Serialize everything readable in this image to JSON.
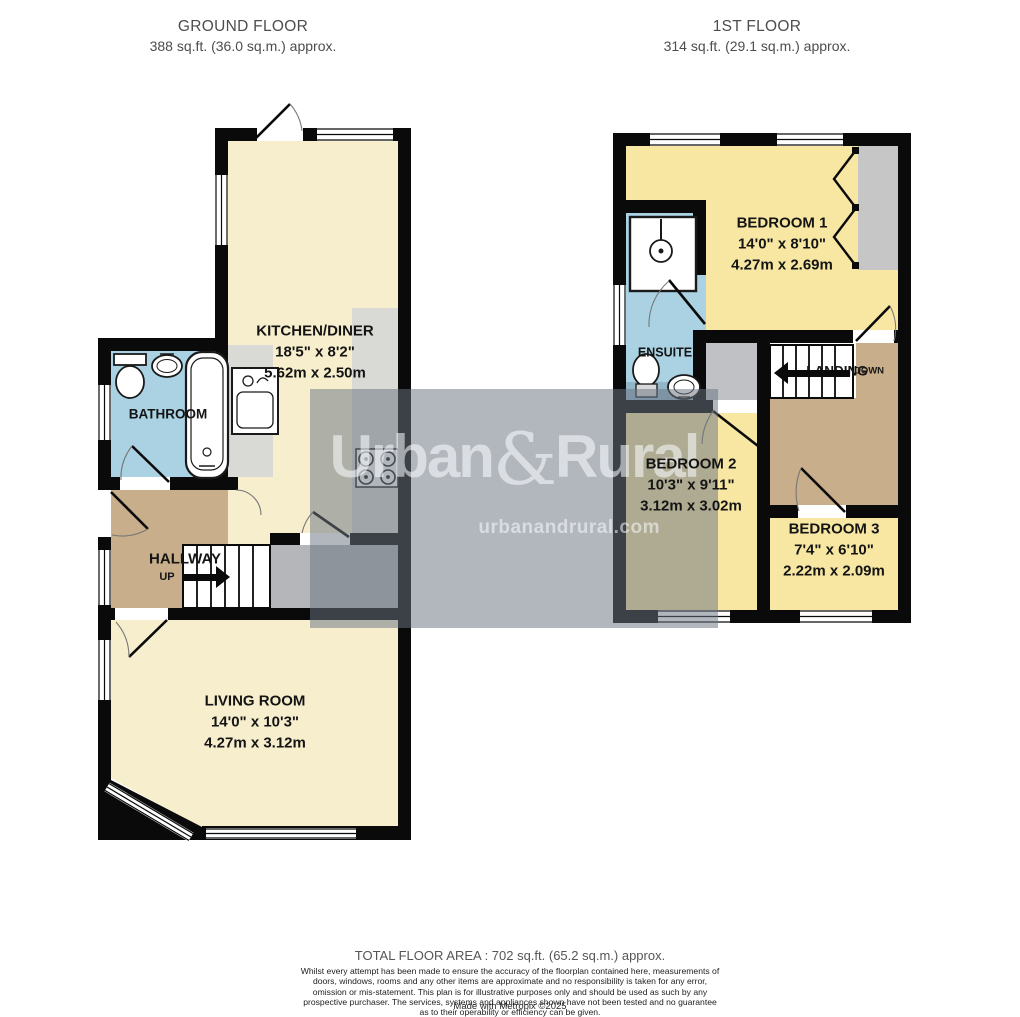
{
  "headers": {
    "ground_floor": {
      "title": "GROUND FLOOR",
      "area": "388 sq.ft. (36.0 sq.m.) approx."
    },
    "first_floor": {
      "title": "1ST FLOOR",
      "area": "314 sq.ft. (29.1 sq.m.) approx."
    }
  },
  "rooms": {
    "kitchen_diner": {
      "name": "KITCHEN/DINER",
      "size_imperial": "18'5\"  x 8'2\"",
      "size_metric": "5.62m  x 2.50m"
    },
    "bathroom": {
      "name": "BATHROOM"
    },
    "hallway": {
      "name": "HALLWAY",
      "direction": "UP"
    },
    "living_room": {
      "name": "LIVING ROOM",
      "size_imperial": "14'0\"  x 10'3\"",
      "size_metric": "4.27m  x 3.12m"
    },
    "bedroom_1": {
      "name": "BEDROOM 1",
      "size_imperial": "14'0\"  x 8'10\"",
      "size_metric": "4.27m  x 2.69m"
    },
    "ensuite": {
      "name": "ENSUITE"
    },
    "landing": {
      "name": "LANDING",
      "direction": "DOWN"
    },
    "bedroom_2": {
      "name": "BEDROOM 2",
      "size_imperial": "10'3\"  x 9'11\"",
      "size_metric": "3.12m  x 3.02m"
    },
    "bedroom_3": {
      "name": "BEDROOM 3",
      "size_imperial": "7'4\"  x 6'10\"",
      "size_metric": "2.22m  x 2.09m"
    }
  },
  "watermark": {
    "brand_first": "Urban",
    "brand_amp": "&",
    "brand_second": "Rural",
    "website": "urbanandrural.com"
  },
  "footer": {
    "total_area": "TOTAL FLOOR AREA : 702 sq.ft. (65.2 sq.m.) approx.",
    "disclaimer": "Whilst every attempt has been made to ensure the accuracy of the floorplan contained here, measurements of doors, windows, rooms and any other items are approximate and no responsibility is taken for any error, omission or mis-statement. This plan is for illustrative purposes only and should be used as such by any prospective purchaser. The services, systems and appliances shown have not been tested and no guarantee as to their operability or efficiency can be given.",
    "credit": "Made with Metropix ©2025"
  },
  "colors": {
    "wall": "#0a0a0a",
    "room_cream": "#f6eecd",
    "room_yellow": "#f7e7a3",
    "room_blue": "#aad2e2",
    "room_tan": "#c9ae8b",
    "counter_gray": "#d9d9d6",
    "wardrobe_gray": "#c6c6c6",
    "lobby_gray": "#b4b6b9",
    "watermark_overlay": "#6b7582"
  }
}
